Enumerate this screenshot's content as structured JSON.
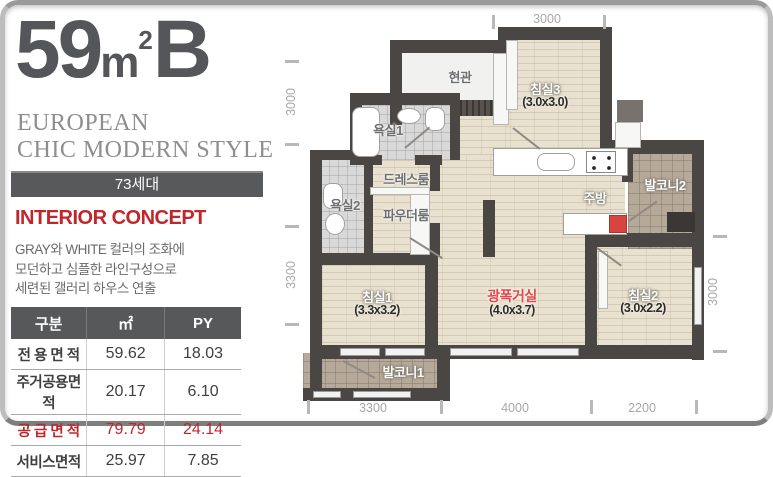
{
  "panel": {
    "size_number": "59",
    "size_unit": "m",
    "size_sup": "2",
    "size_type": "B",
    "style_line1": "EUROPEAN",
    "style_line2": "CHIC MODERN STYLE",
    "units_badge": "73세대",
    "concept_title": "INTERIOR CONCEPT",
    "concept_lines": [
      "GRAY와 WHITE 컬러의 조화에",
      "모던하고 심플한 라인구성으로",
      "세련된 갤러리 하우스 연출"
    ],
    "table": {
      "headers": [
        "구분",
        "㎡",
        "PY"
      ],
      "rows": [
        {
          "label": "전 용 면 적",
          "m2": "59.62",
          "py": "18.03"
        },
        {
          "label": "주거공용면적",
          "m2": "20.17",
          "py": "6.10"
        },
        {
          "label": "공 급 면 적",
          "m2": "79.79",
          "py": "24.14"
        },
        {
          "label": "서비스면적",
          "m2": "25.97",
          "py": "7.85"
        }
      ]
    }
  },
  "plan": {
    "rooms": {
      "entrance": "현관",
      "bedroom3": {
        "name": "침실3",
        "dim": "(3.0x3.0)"
      },
      "bath1": "욕실1",
      "dressroom": "드레스룸",
      "powderroom": "파우더룸",
      "bath2": "욕실2",
      "kitchen": "주방",
      "balcony2": "발코니2",
      "bedroom1": {
        "name": "침실1",
        "dim": "(3.3x3.2)"
      },
      "living": {
        "name": "광폭거실",
        "dim": "(4.0x3.7)"
      },
      "bedroom2": {
        "name": "침실2",
        "dim": "(3.0x2.2)"
      },
      "balcony1": "발코니1"
    },
    "dimensions": {
      "top": "3000",
      "left_upper": "3000",
      "left_lower": "3300",
      "right": "3000",
      "bottom": [
        "3300",
        "4000",
        "2200"
      ]
    }
  },
  "colors": {
    "accent_red": "#c0272d",
    "wall": "#4a4644",
    "wood_floor": "#e9e1cf",
    "balcony_tile": "#b5a999",
    "bath_tile": "#d9d9d9",
    "badge_gray": "#58595b"
  }
}
